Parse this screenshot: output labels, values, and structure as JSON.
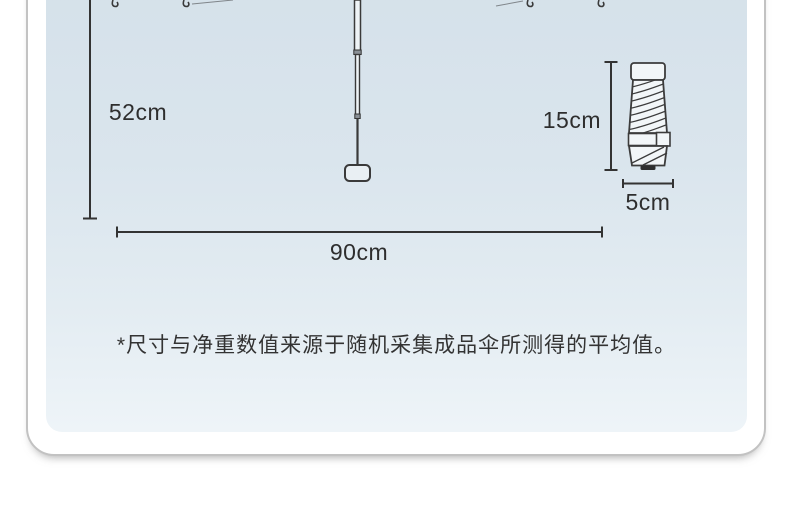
{
  "page": {
    "background": "#ffffff"
  },
  "card": {
    "background": "#ffffff",
    "border_color": "#c2c2c2",
    "panel_gradient_top": "#d5e1ea",
    "panel_gradient_bottom": "#eef4f8"
  },
  "diagram": {
    "line_color": "#333333",
    "open_umbrella": {
      "height_label": "52cm",
      "width_label": "90cm"
    },
    "folded_umbrella": {
      "height_label": "15cm",
      "width_label": "5cm"
    },
    "footnote": "*尺寸与净重数值来源于随机采集成品伞所测得的平均值。"
  }
}
